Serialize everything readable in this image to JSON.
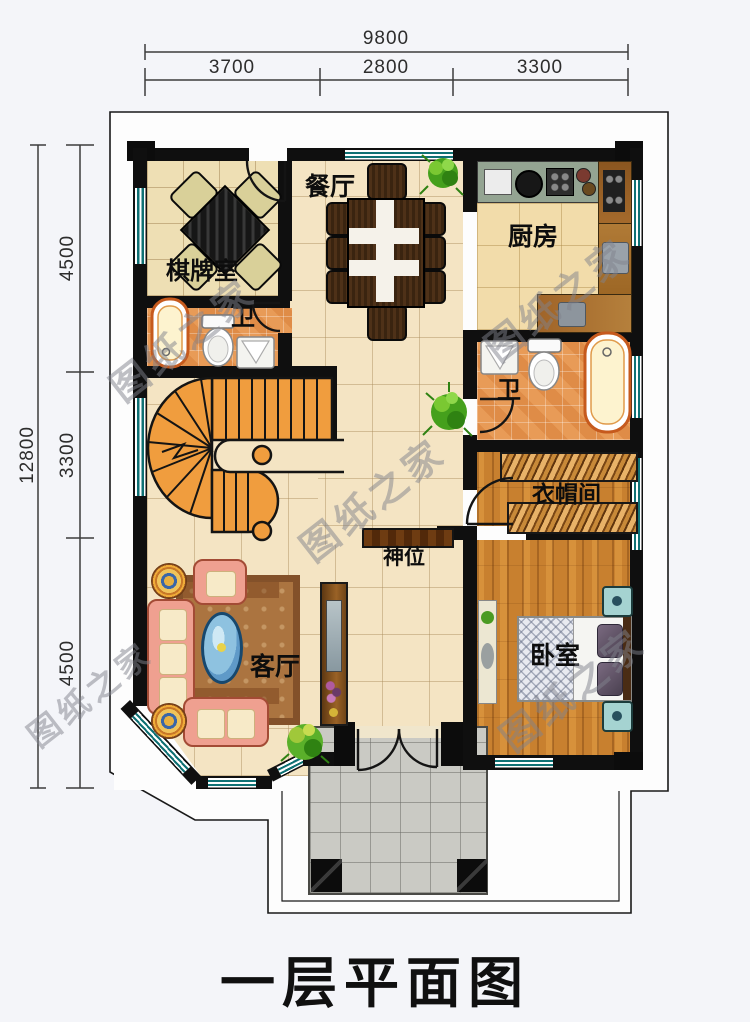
{
  "title": "一层平面图",
  "watermark": "图纸之家",
  "dimensions": {
    "top": {
      "total": "9800",
      "segments": [
        "3700",
        "2800",
        "3300"
      ]
    },
    "left": {
      "total": "12800",
      "segments": [
        "4500",
        "3300",
        "4500"
      ]
    }
  },
  "rooms": {
    "dining": "餐厅",
    "kitchen": "厨房",
    "chess_room": "棋牌室",
    "bath_left": "卫",
    "bath_right": "卫",
    "cloakroom": "衣帽间",
    "shrine": "神位",
    "living": "客厅",
    "bedroom": "卧室"
  },
  "colors": {
    "wall": "#0f0f0f",
    "floor_cream": "#f4e4c3",
    "floor_wood": "#c8802f",
    "bath_tile": "#e89b57",
    "stair": "#f09d3e",
    "window_teal": "#0f7174",
    "porch_tile": "#cacac4"
  }
}
